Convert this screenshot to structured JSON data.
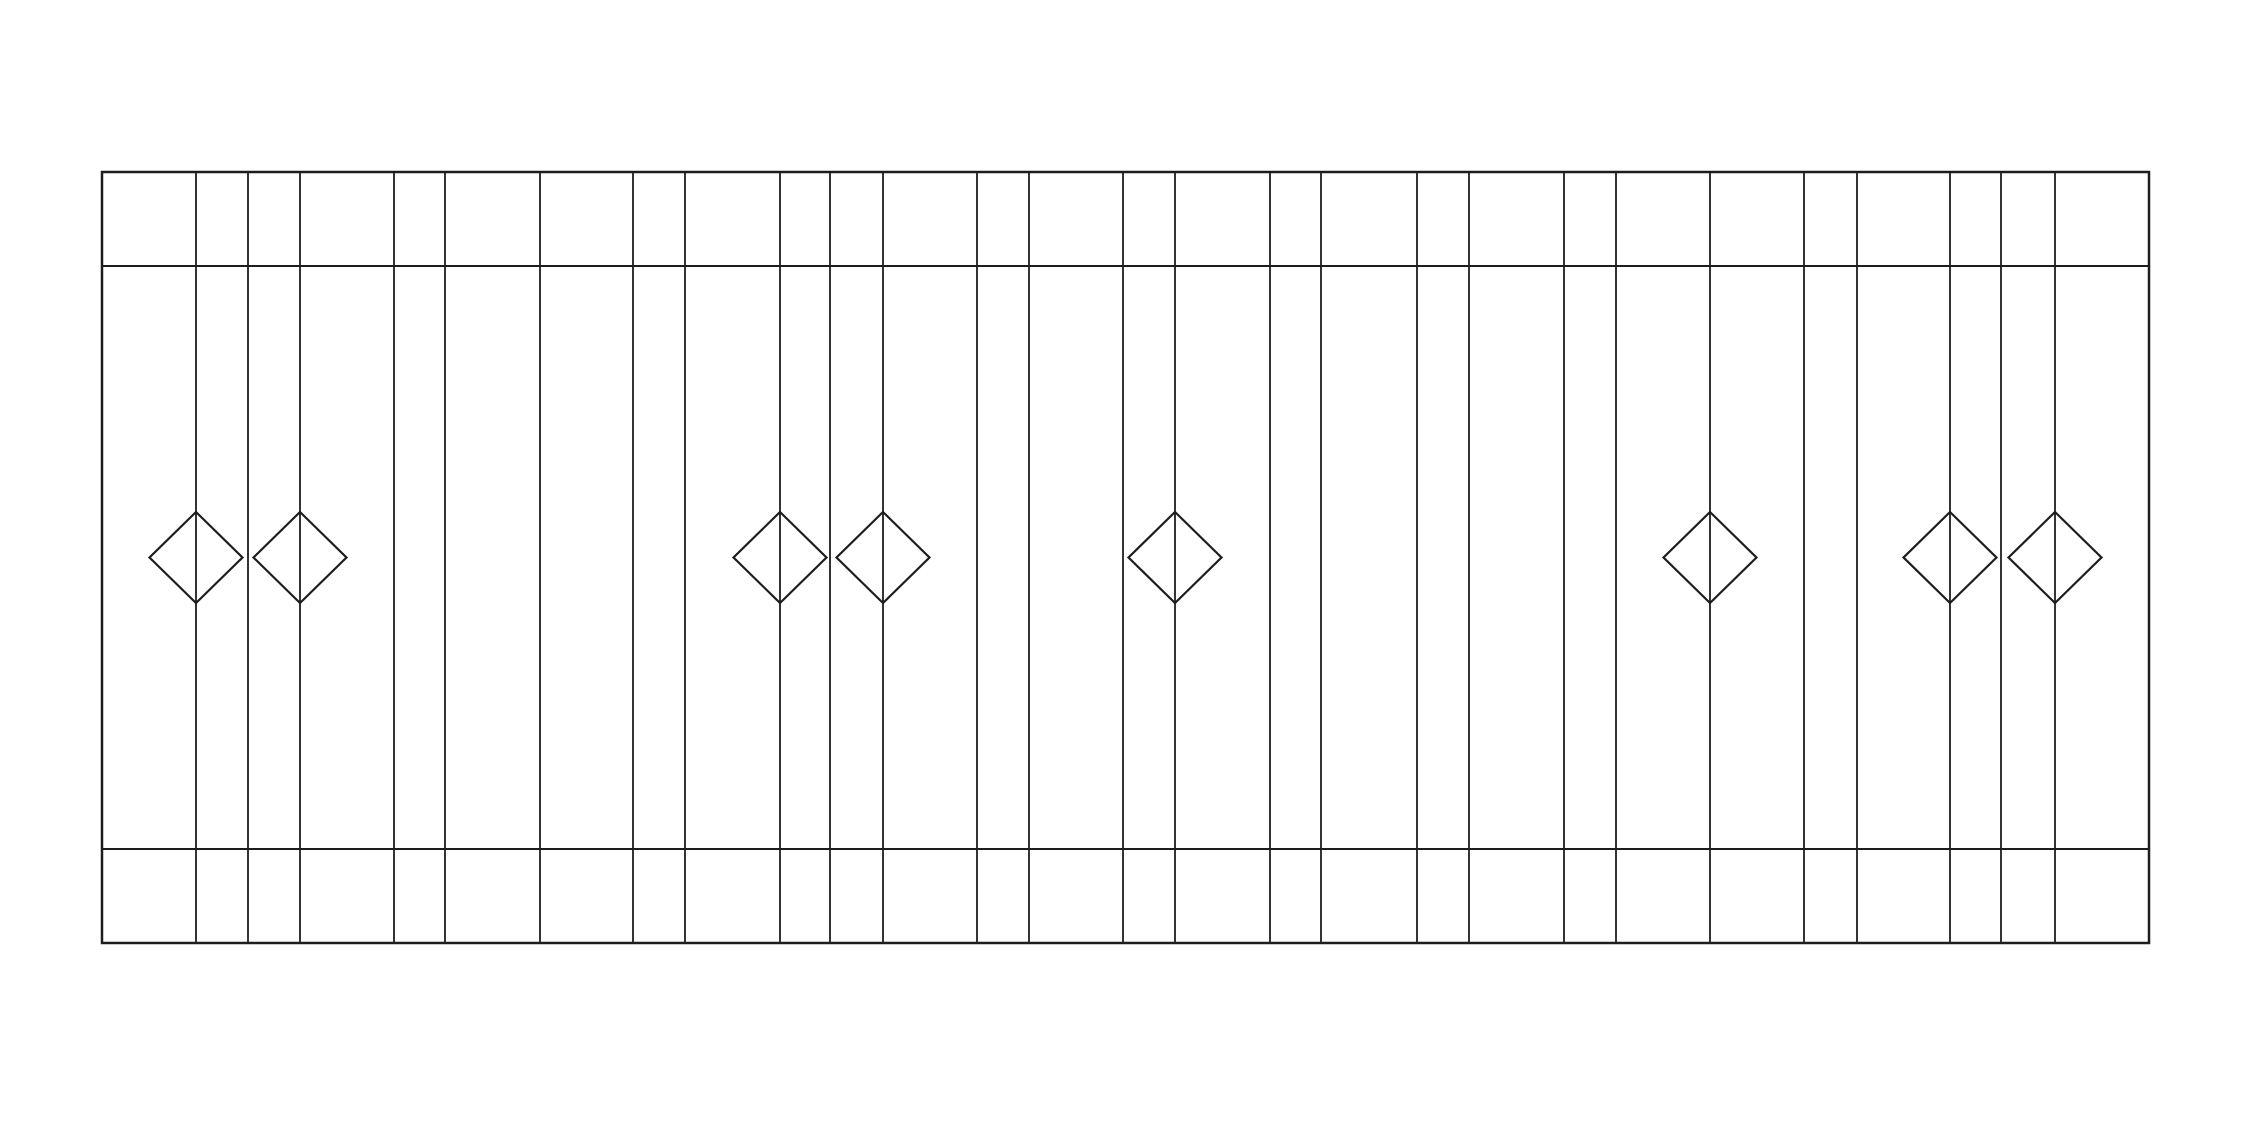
{
  "canvas": {
    "width": 2251,
    "height": 1122,
    "background_color": "#ffffff"
  },
  "drawing": {
    "description": "fence-elevation-line-drawing",
    "stroke_color": "#1d1d1d",
    "frame": {
      "x1": 102,
      "y1": 172,
      "x2": 2149,
      "y2": 943,
      "stroke_width": 2.5
    },
    "rails": {
      "y_positions": [
        266,
        849
      ],
      "stroke_width": 2
    },
    "verticals": {
      "x_positions": [
        196,
        248,
        300,
        394,
        445,
        540,
        633,
        685,
        780,
        830,
        883,
        977,
        1029,
        1123,
        1175,
        1270,
        1321,
        1417,
        1469,
        1564,
        1616,
        1710,
        1804,
        1857,
        1950,
        2001,
        2055
      ],
      "stroke_width": 1.8
    },
    "diamonds": {
      "centers_x": [
        196,
        300,
        780,
        883,
        1175,
        1710,
        1950,
        2055
      ],
      "center_y": 557.5,
      "half_diagonal_x": 46.5,
      "half_diagonal_y": 45.5,
      "stroke_width": 2.2,
      "fill": "none"
    }
  }
}
